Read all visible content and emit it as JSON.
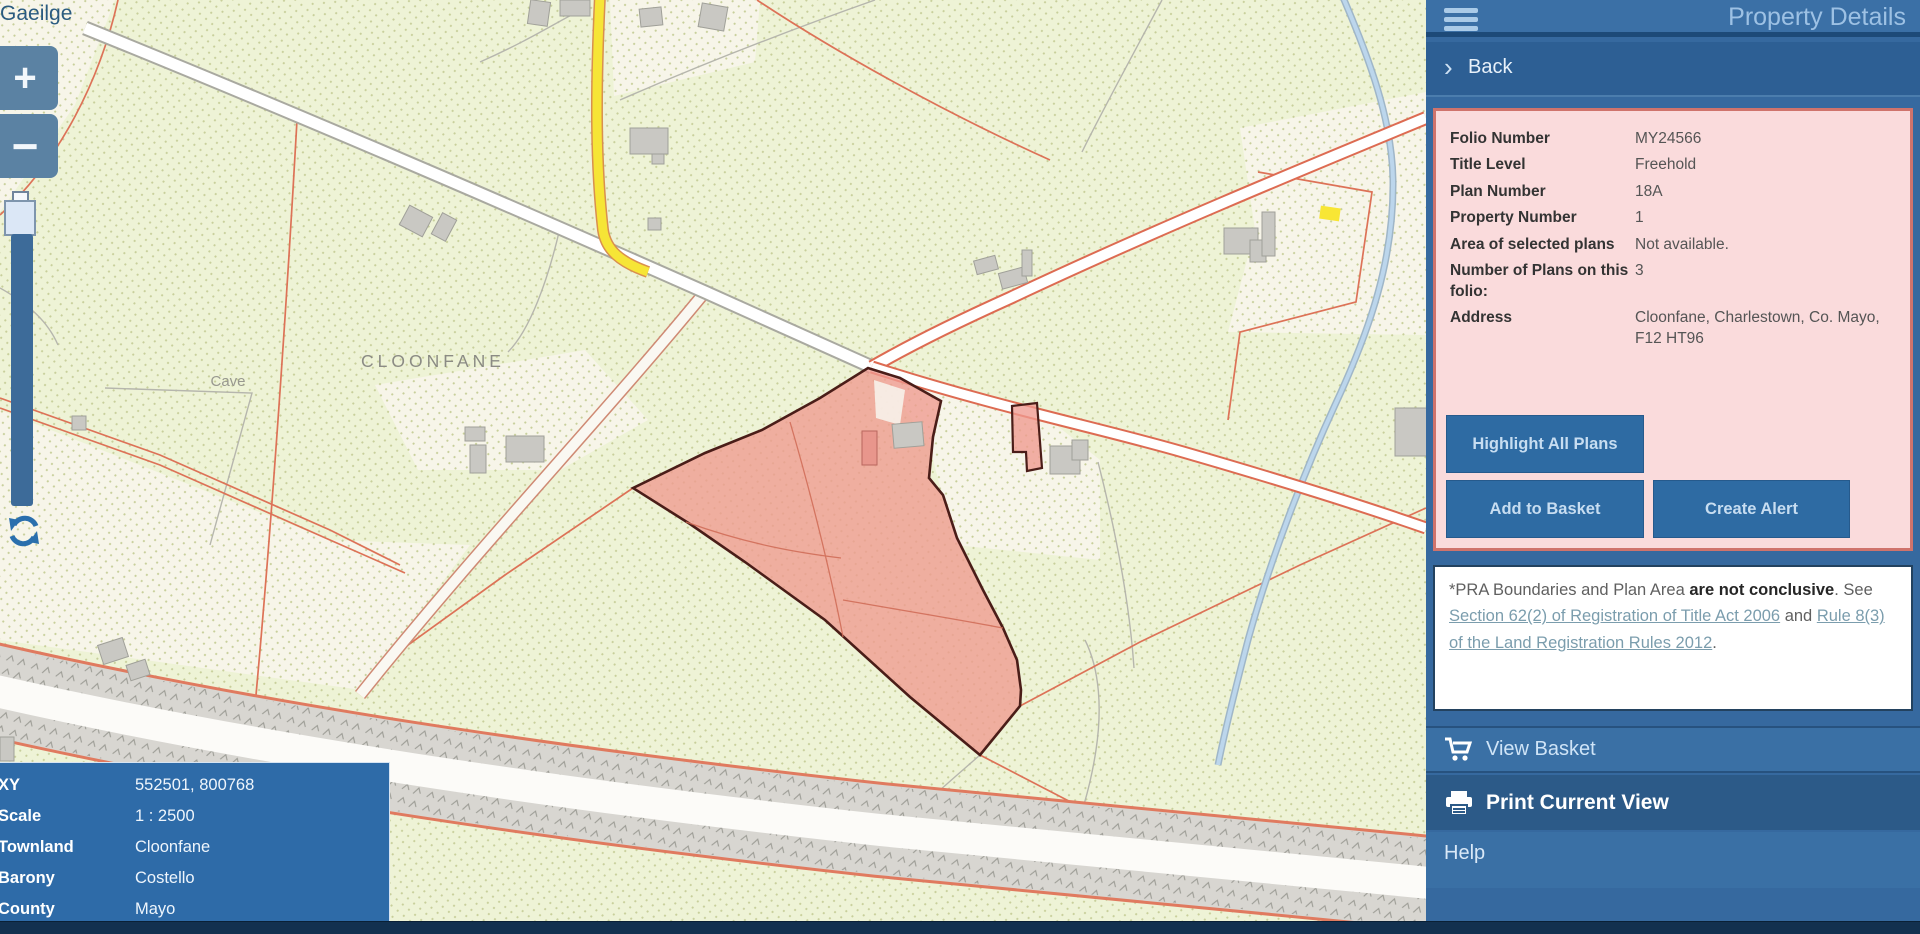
{
  "colors": {
    "map_bg": "#eef3d6",
    "panel_bg": "#36699f",
    "header_bg": "#3b70a6",
    "back_bg": "#2d5f94",
    "dark_row_bg": "#2c5a88",
    "button_bg": "#2e6ba3",
    "pink_bg": "#fadbdc",
    "pink_border": "#cf736c",
    "highlight_fill": "#ef9a90",
    "highlight_border": "#4a1d18",
    "navy_bar": "#12304f"
  },
  "map": {
    "language_link": "Gaeilge",
    "zoom_in_label": "+",
    "zoom_out_label": "−",
    "labels": {
      "townland": "CLOONFANE",
      "cave": "Cave"
    },
    "info_box": {
      "rows": [
        {
          "label": "XY",
          "value": "552501, 800768"
        },
        {
          "label": "Scale",
          "value": "1 : 2500"
        },
        {
          "label": "Townland",
          "value": "Cloonfane"
        },
        {
          "label": "Barony",
          "value": "Costello"
        },
        {
          "label": "County",
          "value": "Mayo"
        }
      ]
    }
  },
  "panel": {
    "title": "Property Details",
    "back_label": "Back",
    "details": {
      "rows": [
        {
          "label": "Folio Number",
          "value": "MY24566"
        },
        {
          "label": "Title Level",
          "value": "Freehold"
        },
        {
          "label": "Plan Number",
          "value": "18A"
        },
        {
          "label": "Property Number",
          "value": "1"
        },
        {
          "label": "Area of selected plans",
          "value": "Not available."
        },
        {
          "label": "Number of Plans on this folio:",
          "value": "3"
        },
        {
          "label": "Address",
          "value": "Cloonfane, Charlestown, Co. Mayo, F12 HT96"
        }
      ]
    },
    "buttons": {
      "highlight_all_plans": "Highlight All Plans",
      "add_to_basket": "Add to Basket",
      "create_alert": "Create Alert"
    },
    "disclaimer": {
      "prefix": "*PRA Boundaries and Plan Area ",
      "bold": "are not conclusive",
      "mid1": ". See ",
      "link1": "Section 62(2) of Registration of Title Act 2006",
      "mid2": " and ",
      "link2": "Rule 8(3) of the Land Registration Rules 2012",
      "suffix": "."
    },
    "actions": {
      "view_basket": "View Basket",
      "print_current_view": "Print Current View",
      "help": "Help"
    }
  }
}
